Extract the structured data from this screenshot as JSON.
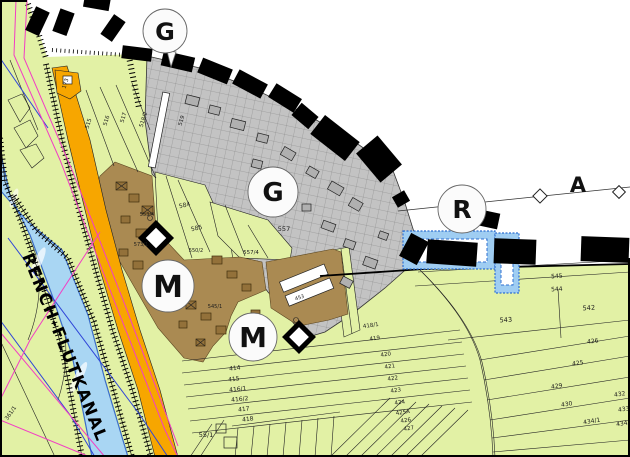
{
  "map": {
    "canal_label": "RENCH-FLUTKANAL",
    "area_label": "A",
    "zone_markers": [
      {
        "id": "g-top",
        "letter": "G"
      },
      {
        "id": "g-center",
        "letter": "G"
      },
      {
        "id": "r-right",
        "letter": "R"
      },
      {
        "id": "m-upper",
        "letter": "M"
      },
      {
        "id": "m-lower",
        "letter": "M"
      }
    ],
    "colors": {
      "field_green": "#e2f1a5",
      "commercial_gray": "#c3c3c3",
      "mixed_brown": "#aa8a52",
      "road_orange": "#f7a600",
      "water_blue": "#a9d6f3",
      "wavy_blue": "#9fcdf2",
      "boundary_black": "#000000",
      "magenta_line": "#f23ec4",
      "blue_line": "#2f45d8"
    },
    "parcel_labels": [
      {
        "t": "173",
        "x": 67,
        "y": 84,
        "r": -72,
        "s": 5.5
      },
      {
        "t": "515",
        "x": 90,
        "y": 124,
        "r": -73,
        "s": 5.5
      },
      {
        "t": "516",
        "x": 108,
        "y": 121,
        "r": -73,
        "s": 5.5
      },
      {
        "t": "517",
        "x": 125,
        "y": 118,
        "r": -73,
        "s": 5.5
      },
      {
        "t": "518/2",
        "x": 145,
        "y": 120,
        "r": -73,
        "s": 5.5
      },
      {
        "t": "519",
        "x": 183,
        "y": 121,
        "r": -73,
        "s": 5.5
      },
      {
        "t": "584",
        "x": 185,
        "y": 207,
        "r": -12,
        "s": 6
      },
      {
        "t": "585",
        "x": 197,
        "y": 230,
        "r": -12,
        "s": 6
      },
      {
        "t": "557",
        "x": 284,
        "y": 231,
        "r": 0,
        "s": 6.5
      },
      {
        "t": "557/4",
        "x": 251,
        "y": 254,
        "r": 0,
        "s": 5.5
      },
      {
        "t": "553/4",
        "x": 147,
        "y": 216,
        "r": 0,
        "s": 5
      },
      {
        "t": "573/1",
        "x": 141,
        "y": 246,
        "r": 0,
        "s": 5
      },
      {
        "t": "550/2",
        "x": 196,
        "y": 252,
        "r": 0,
        "s": 5
      },
      {
        "t": "545/1",
        "x": 215,
        "y": 308,
        "r": 0,
        "s": 5
      },
      {
        "t": "453",
        "x": 300,
        "y": 299,
        "r": -18,
        "s": 5
      },
      {
        "t": "414",
        "x": 235,
        "y": 370,
        "r": -6,
        "s": 6
      },
      {
        "t": "415",
        "x": 234,
        "y": 381,
        "r": -6,
        "s": 6
      },
      {
        "t": "416/1",
        "x": 238,
        "y": 391,
        "r": -6,
        "s": 6
      },
      {
        "t": "416/2",
        "x": 240,
        "y": 401,
        "r": -6,
        "s": 6
      },
      {
        "t": "417",
        "x": 244,
        "y": 411,
        "r": -6,
        "s": 6
      },
      {
        "t": "418",
        "x": 248,
        "y": 421,
        "r": -6,
        "s": 6
      },
      {
        "t": "55/1",
        "x": 206,
        "y": 437,
        "r": 0,
        "s": 6.5
      },
      {
        "t": "361/1",
        "x": 12,
        "y": 414,
        "r": -55,
        "s": 5.5
      },
      {
        "t": "545",
        "x": 557,
        "y": 278,
        "r": -4,
        "s": 6
      },
      {
        "t": "544",
        "x": 557,
        "y": 291,
        "r": -4,
        "s": 6
      },
      {
        "t": "543",
        "x": 506,
        "y": 322,
        "r": -4,
        "s": 6.5
      },
      {
        "t": "542",
        "x": 589,
        "y": 310,
        "r": -4,
        "s": 6.5
      },
      {
        "t": "426",
        "x": 593,
        "y": 343,
        "r": -7,
        "s": 6
      },
      {
        "t": "425",
        "x": 578,
        "y": 365,
        "r": -7,
        "s": 6
      },
      {
        "t": "429",
        "x": 557,
        "y": 388,
        "r": -9,
        "s": 6
      },
      {
        "t": "432",
        "x": 620,
        "y": 396,
        "r": -9,
        "s": 6
      },
      {
        "t": "430",
        "x": 567,
        "y": 406,
        "r": -9,
        "s": 6
      },
      {
        "t": "433",
        "x": 624,
        "y": 411,
        "r": -9,
        "s": 6
      },
      {
        "t": "434/1",
        "x": 592,
        "y": 423,
        "r": -9,
        "s": 6
      },
      {
        "t": "434/2",
        "x": 625,
        "y": 425,
        "r": -9,
        "s": 6
      },
      {
        "t": "418/1",
        "x": 371,
        "y": 327,
        "r": -8,
        "s": 5.5
      },
      {
        "t": "419",
        "x": 375,
        "y": 340,
        "r": -8,
        "s": 5.5
      },
      {
        "t": "420",
        "x": 386,
        "y": 356,
        "r": -8,
        "s": 5.5
      },
      {
        "t": "421",
        "x": 390,
        "y": 368,
        "r": -8,
        "s": 5.5
      },
      {
        "t": "422",
        "x": 393,
        "y": 380,
        "r": -8,
        "s": 5.5
      },
      {
        "t": "423",
        "x": 396,
        "y": 392,
        "r": -8,
        "s": 5.5
      },
      {
        "t": "424",
        "x": 400,
        "y": 404,
        "r": -8,
        "s": 5.5
      },
      {
        "t": "425A",
        "x": 403,
        "y": 414,
        "r": -8,
        "s": 5.5
      },
      {
        "t": "426",
        "x": 406,
        "y": 422,
        "r": -8,
        "s": 5.5
      },
      {
        "t": "427",
        "x": 409,
        "y": 430,
        "r": -8,
        "s": 5.5
      }
    ]
  }
}
